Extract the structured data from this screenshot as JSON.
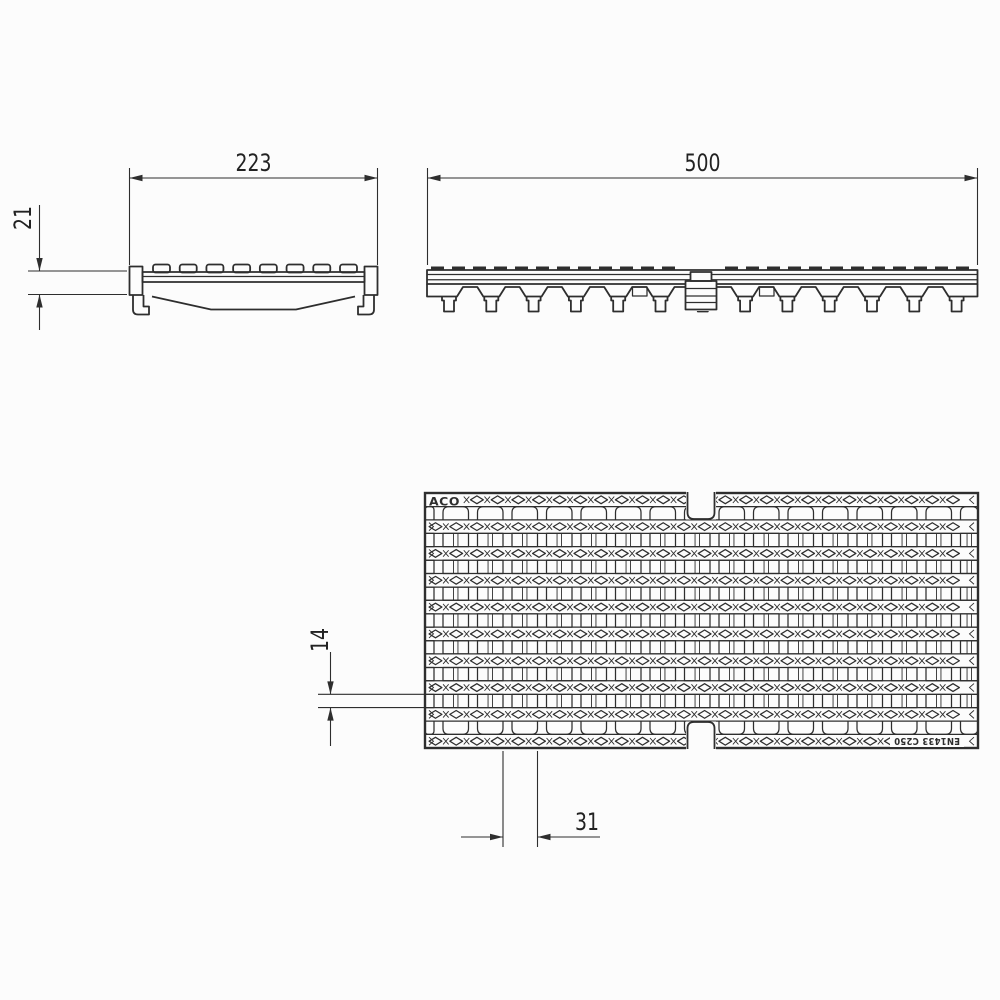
{
  "document": {
    "title": "ACO drainage channel grating - technical drawing",
    "type": "technical-drawing",
    "views": [
      "cross-section end view",
      "side elevation view",
      "plan view of grate"
    ]
  },
  "dimensions": {
    "section_width": "223",
    "edge_height": "21",
    "length": "500",
    "slot_width": "14",
    "slot_pitch": "31"
  },
  "labels": {
    "brand": "ACO",
    "standard": "EN1433 C250"
  },
  "style": {
    "background": "#fcfcfc",
    "line_color": "#2e2e2e",
    "text_color": "#222222"
  },
  "geometry": {
    "plan": {
      "x": 425,
      "y": 493,
      "w": 553,
      "h": 255,
      "bar_rows": 10,
      "bar_height": 13.6,
      "vertical_pitch": 34.5,
      "vertical_width": 9,
      "vertical_x0": 434,
      "diamond_pitch": 20.7
    },
    "side": {
      "x": 427,
      "y": 270,
      "w": 550.5,
      "bar_height": 14,
      "feet": 13,
      "foot_pitch": 42.3,
      "first_foot_center": 449,
      "tread_dash_pitch": 21
    },
    "section": {
      "x": 129.5,
      "w": 248,
      "lugs": 8
    }
  }
}
